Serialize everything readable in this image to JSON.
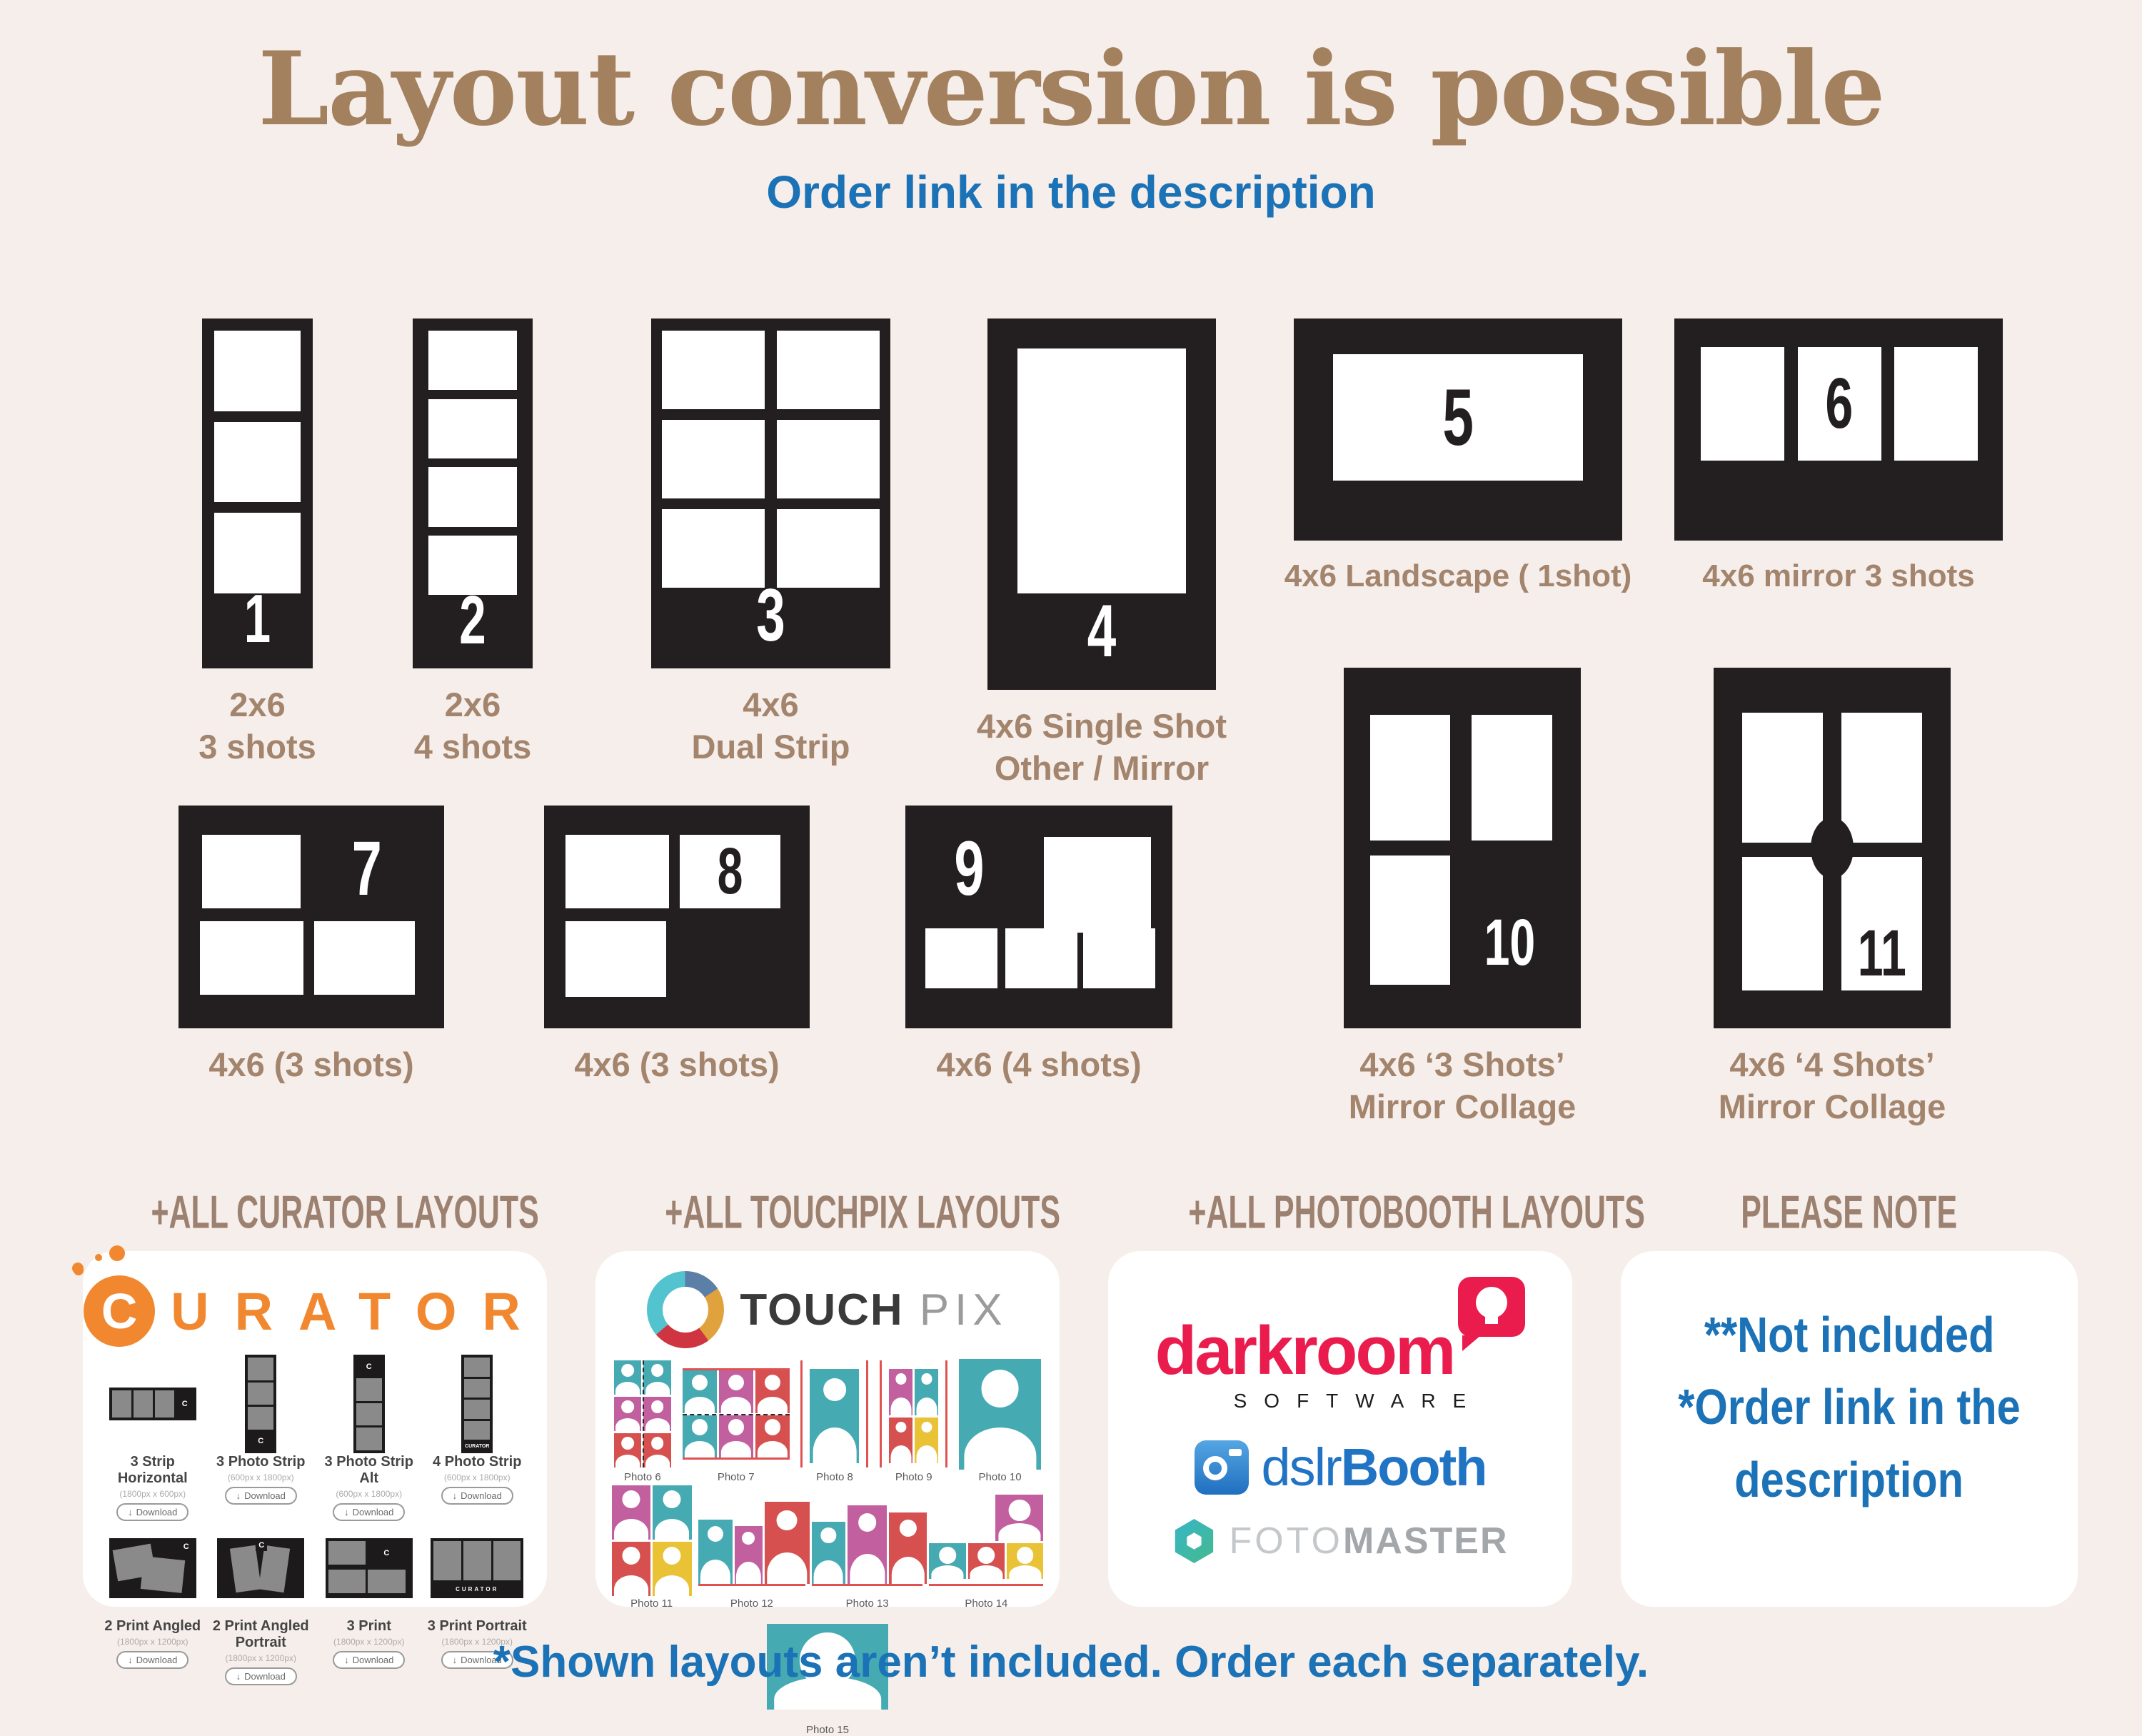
{
  "colors": {
    "background": "#f6eeea",
    "card_black": "#231f20",
    "title_brown": "#a3805e",
    "label_brown": "#a3846d",
    "accent_blue": "#1b72b6",
    "curator_orange": "#f1882f",
    "touchpix_teal": "#45aab2",
    "touchpix_magenta": "#c2609f",
    "touchpix_red": "#d65050",
    "touchpix_yellow": "#e9c235",
    "darkroom_red": "#ea1c4d",
    "dslrbooth_blue": "#2173c4",
    "fotomaster_gray": "#a3a7aa"
  },
  "header": {
    "title": "Layout conversion is possible",
    "subtitle": "Order link in the description"
  },
  "layouts": [
    {
      "number": "1",
      "label_lines": [
        "2x6",
        "3 shots"
      ]
    },
    {
      "number": "2",
      "label_lines": [
        "2x6",
        "4 shots"
      ]
    },
    {
      "number": "3",
      "label_lines": [
        "4x6",
        "Dual Strip"
      ]
    },
    {
      "number": "4",
      "label_lines": [
        "4x6 Single Shot",
        "Other / Mirror"
      ]
    },
    {
      "number": "5",
      "label_lines": [
        "4x6 Landscape ( 1shot)"
      ]
    },
    {
      "number": "6",
      "label_lines": [
        "4x6 mirror 3 shots"
      ]
    },
    {
      "number": "7",
      "label_lines": [
        "4x6 (3 shots)"
      ]
    },
    {
      "number": "8",
      "label_lines": [
        "4x6 (3 shots)"
      ]
    },
    {
      "number": "9",
      "label_lines": [
        "4x6 (4 shots)"
      ]
    },
    {
      "number": "10",
      "label_lines": [
        "4x6 ‘3 Shots’",
        "Mirror Collage"
      ]
    },
    {
      "number": "11",
      "label_lines": [
        "4x6 ‘4 Shots’",
        "Mirror Collage"
      ]
    }
  ],
  "sections": {
    "curator_header": "+ALL CURATOR LAYOUTS",
    "touchpix_header": "+ALL TOUCHPIX LAYOUTS",
    "photobooth_header": "+ALL PHOTOBOOTH LAYOUTS",
    "note_header": "PLEASE NOTE"
  },
  "curator": {
    "logo_c": "C",
    "logo_rest": "URATOR",
    "items": [
      {
        "name": "3 Strip Horizontal",
        "dims": "(1800px x 600px)",
        "button": "Download",
        "thumb": "h3strip"
      },
      {
        "name": "3 Photo Strip",
        "dims": "(600px x 1800px)",
        "button": "Download",
        "thumb": "v3strip"
      },
      {
        "name": "3 Photo Strip Alt",
        "dims": "(600px x 1800px)",
        "button": "Download",
        "thumb": "v3stripalt"
      },
      {
        "name": "4 Photo Strip",
        "dims": "(600px x 1800px)",
        "button": "Download",
        "thumb": "v4strip"
      },
      {
        "name": "2 Print Angled",
        "dims": "(1800px x 1200px)",
        "button": "Download",
        "thumb": "angled2"
      },
      {
        "name": "2 Print Angled Portrait",
        "dims": "(1800px x 1200px)",
        "button": "Download",
        "thumb": "angledp2"
      },
      {
        "name": "3 Print",
        "dims": "(1800px x 1200px)",
        "button": "Download",
        "thumb": "print3"
      },
      {
        "name": "3 Print Portrait",
        "dims": "(1800px x 1200px)",
        "button": "Download",
        "thumb": "printp3"
      }
    ]
  },
  "touchpix": {
    "logo_bold": "TOUCH",
    "logo_light": "PIX",
    "items": [
      {
        "label": "Photo 6",
        "type": "grid",
        "cols": 2,
        "colors": [
          "teal",
          "teal",
          "mag",
          "mag",
          "red",
          "red"
        ],
        "w": 80,
        "h": 150,
        "deco": "dash-v"
      },
      {
        "label": "Photo 7",
        "type": "grid",
        "cols": 3,
        "colors": [
          "teal",
          "mag",
          "red",
          "teal",
          "mag",
          "red"
        ],
        "w": 150,
        "h": 128,
        "deco": "dash-h redtb"
      },
      {
        "label": "Photo 8",
        "type": "single",
        "colors": [
          "teal"
        ],
        "w": 95,
        "h": 150,
        "deco": "redlr pad"
      },
      {
        "label": "Photo 9",
        "type": "grid",
        "cols": 2,
        "colors": [
          "mag",
          "teal",
          "red",
          "yel"
        ],
        "w": 95,
        "h": 150,
        "deco": "redlr pad"
      },
      {
        "label": "Photo 10",
        "type": "single",
        "colors": [
          "teal"
        ],
        "w": 115,
        "h": 155,
        "deco": ""
      },
      {
        "label": "Photo 11",
        "type": "grid",
        "cols": 2,
        "colors": [
          "mag",
          "teal",
          "red",
          "yel"
        ],
        "w": 112,
        "h": 155,
        "deco": ""
      },
      {
        "label": "Photo 12",
        "type": "skyline",
        "colors": [
          "teal",
          "mag",
          "red"
        ],
        "heights": [
          72,
          65,
          92
        ],
        "widths": [
          32,
          26,
          42
        ],
        "w": 150,
        "h": 128,
        "deco": "redb"
      },
      {
        "label": "Photo 13",
        "type": "skyline",
        "colors": [
          "teal",
          "mag",
          "red"
        ],
        "heights": [
          70,
          88,
          80
        ],
        "widths": [
          30,
          36,
          34
        ],
        "w": 155,
        "h": 128,
        "deco": "redb"
      },
      {
        "label": "Photo 14",
        "type": "top1bottom3",
        "colors": [
          "mag",
          "teal",
          "red",
          "yel"
        ],
        "w": 160,
        "h": 128,
        "deco": "redb"
      },
      {
        "label": "Photo 15",
        "type": "single",
        "colors": [
          "teal"
        ],
        "w": 170,
        "h": 120,
        "deco": ""
      }
    ]
  },
  "photobooth": {
    "darkroom": "darkroom",
    "software": "SOFTWARE",
    "dslr": "dslr",
    "booth": "Booth",
    "foto": "FOTO",
    "master": "MASTER"
  },
  "note": {
    "line1": "**Not included",
    "line2": "*Order link in the",
    "line3": "description"
  },
  "footer": {
    "text": "*Shown layouts aren’t included. Order each separately."
  }
}
